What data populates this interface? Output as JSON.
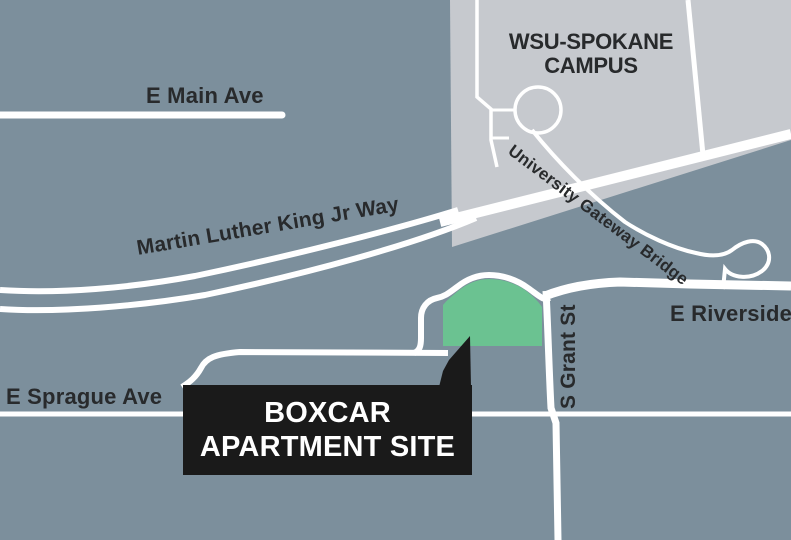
{
  "map": {
    "title": "Boxcar apartment site location map",
    "colors": {
      "background": "#7C8F9C",
      "campus_fill": "#C6C9CE",
      "road": "#FFFFFF",
      "site_fill": "#6BC291",
      "label_text": "#282A2C",
      "callout_bg": "#1A1A1A",
      "callout_text": "#FFFFFF"
    },
    "labels": {
      "e_main_ave": "E Main Ave",
      "mlk_way": "Martin Luther King Jr Way",
      "campus_line1": "WSU-SPOKANE",
      "campus_line2": "CAMPUS",
      "gateway_bridge": "University Gateway Bridge",
      "e_riverside": "E Riverside",
      "s_grant_st": "S Grant St",
      "e_sprague_ave": "E Sprague Ave"
    },
    "callout": {
      "line1": "BOXCAR",
      "line2": "APARTMENT SITE"
    }
  }
}
